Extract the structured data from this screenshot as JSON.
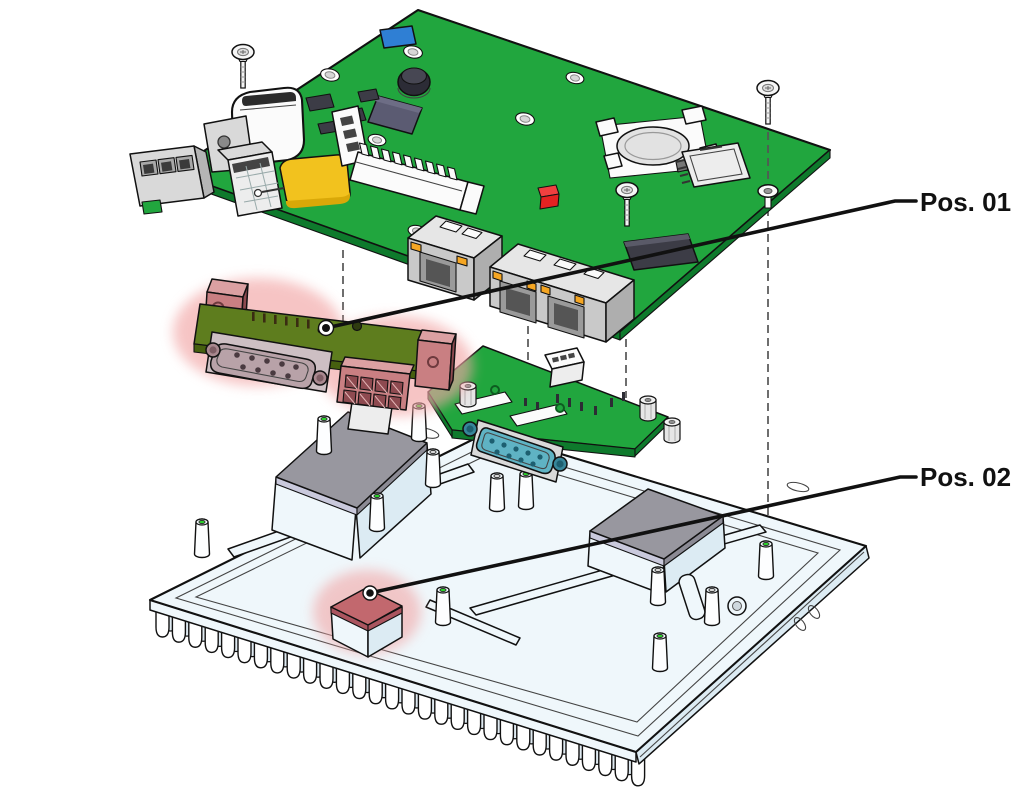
{
  "diagram": {
    "type": "exploded-view-assembly",
    "callouts": {
      "pos01": {
        "label": "Pos. 01",
        "target": "serial-interface-module"
      },
      "pos02": {
        "label": "Pos. 02",
        "target": "thermal-pad-small"
      }
    },
    "parts": [
      "main-carrier-board",
      "mounting-screws",
      "washer",
      "coin-cell-battery-holder",
      "micro-sd-card-slot",
      "rj45-ethernet-port",
      "dual-rj45-ethernet-port",
      "piezo-buzzer",
      "usb-connector",
      "terminal-block-connector",
      "pin-headers",
      "antenna-pad",
      "status-led",
      "io-shroud",
      "serial-interface-module",
      "db9-serial-connector",
      "serial-adapter-board",
      "hex-standoffs",
      "heatsink-chassis",
      "cooling-fins",
      "mounting-posts",
      "thermal-pad-large",
      "thermal-pad-small"
    ]
  },
  "colors": {
    "outline": "#111111",
    "pcb-green": "#21a63e",
    "pcb-green-dark": "#0e7a2c",
    "module-board": "#5e7d1e",
    "module-board-dark": "#46600f",
    "highlight-glow": "#f2a6a6",
    "highlight-pad": "#c2686e",
    "highlight-pad-side": "#aa555f",
    "bracket-red": "#c97f82",
    "bracket-red-light": "#dba0a2",
    "bracket-red-dark": "#8e4a50",
    "heatsink": "#eff7fb",
    "heatsink-shade": "#dcebf3",
    "thermal-pad": "#98979f",
    "thermal-pad-side": "#8b8a94",
    "thermal-pad-light": "#c9c9dc",
    "hole-green": "#2bd32b",
    "teal": "#5fb3c4",
    "teal-dark": "#36869a",
    "teal-deep": "#1d5f70",
    "metal": "#d9d9d9",
    "metal-light": "#ededed",
    "metal-dark": "#b5b5b5",
    "chip-dark": "#3c3c46",
    "chip-blue": "#5b5b72",
    "connector-white": "#fbfbfb",
    "pad-yellow": "#f2c21e",
    "pad-yellow-dark": "#d9a808",
    "led-red": "#e32222",
    "led-orange": "#f5a623",
    "comp-blue": "#2f7fd4",
    "battery-silver": "#e2e2e2",
    "dash-gray": "#555555"
  }
}
